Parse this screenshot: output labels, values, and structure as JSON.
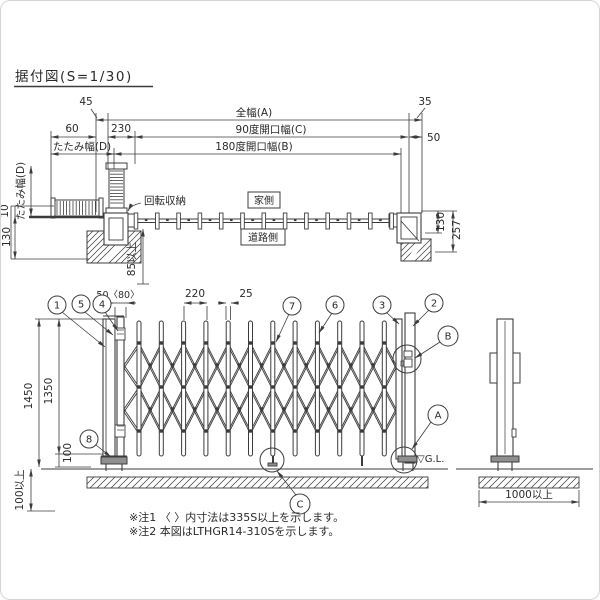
{
  "colors": {
    "line": "#3c3c3c",
    "text": "#2a2a2a",
    "gray_fill": "#8f8f8f",
    "border": "#d5d5d5",
    "background": "#ffffff"
  },
  "title": "据付図(S=1/30)",
  "plan": {
    "dim_45": "45",
    "overall_width": "全幅(A)",
    "dim_35": "35",
    "dim_60": "60",
    "dim_230": "230",
    "opening_90": "90度開口幅(C)",
    "dim_50": "50",
    "fold_width_top": "たたみ幅(D)",
    "opening_180": "180度開口幅(B)",
    "fold_width_left": "たたみ幅(D)",
    "dim_10": "10",
    "dim_130_left": "130",
    "rotation_storage": "回転収納",
    "house_side": "家側",
    "road_side": "道路側",
    "dim_85_min": "85以上",
    "dim_130_right": "130",
    "dim_257": "257"
  },
  "elevation": {
    "balloon_1": "1",
    "balloon_5": "5",
    "balloon_4": "4",
    "balloon_7": "7",
    "balloon_6": "6",
    "balloon_3": "3",
    "balloon_2": "2",
    "balloon_8": "8",
    "balloon_B": "B",
    "balloon_A": "A",
    "balloon_C": "C",
    "dim_50_80": "50〈80〉",
    "dim_220": "220",
    "dim_25": "25",
    "dim_1450": "1450",
    "dim_1350": "1350",
    "dim_100": "100",
    "dim_100_min": "100以上",
    "gl_label": "▽G.L.",
    "dim_1000_min": "1000以上"
  },
  "notes": {
    "note1": "※注1 〈 〉内寸法は335S以上を示します。",
    "note2": "※注2 本図はLTHGR14-310Sを示します。"
  }
}
